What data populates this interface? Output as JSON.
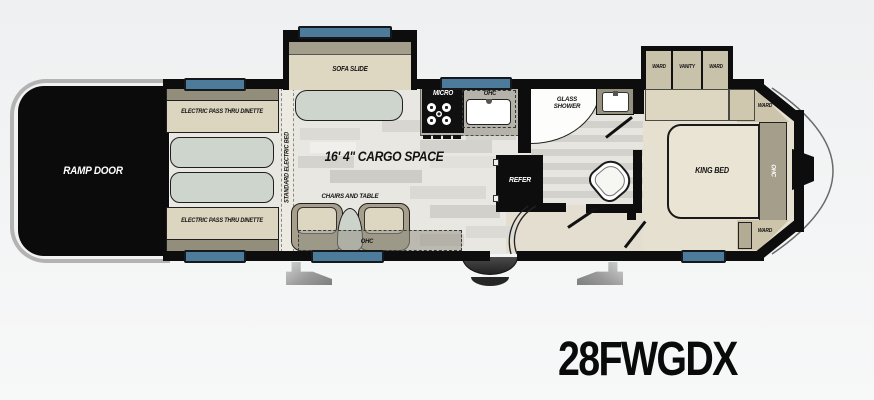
{
  "model": "28FWGDX",
  "labels": {
    "ramp_door": "RAMP DOOR",
    "dinette_top": "ELECTRIC PASS THRU DINETTE",
    "dinette_bottom": "ELECTRIC PASS THRU DINETTE",
    "standard_bed": "STANDARD ELECTRIC BED",
    "sofa_slide": "SOFA SLIDE",
    "cargo": "16' 4\" CARGO SPACE",
    "chairs_table": "CHAIRS AND TABLE",
    "ohc_living": "OHC",
    "micro": "MICRO",
    "ohc_kitchen": "OHC",
    "glass_line1": "GLASS",
    "glass_line2": "SHOWER",
    "refer": "REFER",
    "ward_slide_left": "WARD",
    "vanity": "VANITY",
    "ward_slide_right": "WARD",
    "ward_front_top": "WARD",
    "king_bed": "KING BED",
    "ohc_bedroom": "OHC",
    "ward_front_bottom": "WARD"
  },
  "colors": {
    "wall_black": "#0d0d0d",
    "window_blue": "#4d7b9c",
    "bench_beige": "#dcd5c0",
    "bench_trim": "#938d7b",
    "cushion_sage": "#ced5cd",
    "cabinet_tan": "#c9c2aa",
    "ohc_dark_tan": "#a59e8a",
    "bedroom_floor": "#e6e0d0",
    "cargo_floor": "#e9e7e2",
    "counter_gray": "#b5b2a9"
  }
}
